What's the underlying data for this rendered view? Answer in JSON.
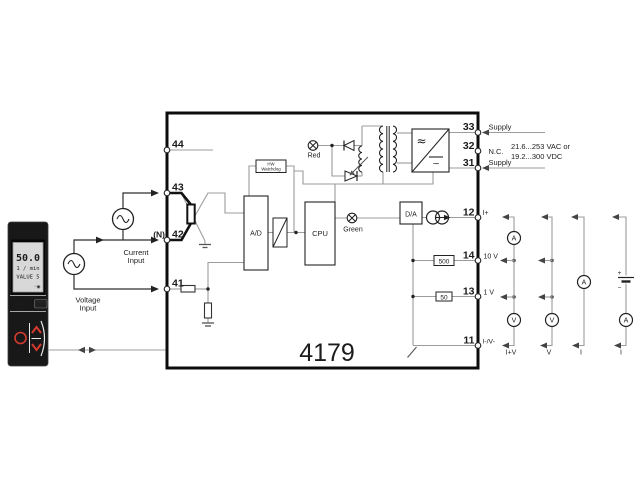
{
  "product_number": "4179",
  "front_unit": {
    "display_value": "50.0",
    "display_unit": "1 / min",
    "display_tag": "VALUE 5",
    "display_icons": "◦◉",
    "brand": "PR",
    "model": "4510"
  },
  "sources": {
    "current_input_line1": "Current",
    "current_input_line2": "Input",
    "voltage_input_line1": "Voltage",
    "voltage_input_line2": "Input",
    "neutral_mark": "(N)"
  },
  "terminals": {
    "t44": "44",
    "t43": "43",
    "t42": "42",
    "t41": "41",
    "t33": "33",
    "t32": "32",
    "t31": "31",
    "t12": "12",
    "t14": "14",
    "t13": "13",
    "t11": "11",
    "t33_label": "Supply",
    "t32_label": "N.C.",
    "t31_label": "Supply",
    "t12_label": "I+",
    "t14_label": "10 V",
    "t13_label": "1 V",
    "t11_label": "I-/V-"
  },
  "power": {
    "range_line1": "21.6...253 VAC or",
    "range_line2": "19.2...300 VDC",
    "ac_symbol": "≈",
    "dc_symbol": "~"
  },
  "blocks": {
    "adc": "A/D",
    "cpu": "CPU",
    "dac": "D/A",
    "watchdog_line1": "HW",
    "watchdog_line2": "Watchdog",
    "resistor_500": "500",
    "resistor_50": "50"
  },
  "leds": {
    "red": "Red",
    "green": "Green"
  },
  "output_meters": {
    "ammeter_top": "A",
    "voltmeter_1": "V",
    "voltmeter_2": "V",
    "ammeter_mid": "A",
    "ammeter_bottom": "A",
    "battery_plus": "+",
    "battery_minus": "−",
    "mode_1": "I+V",
    "mode_2": "V",
    "mode_3": "I",
    "mode_4": "I"
  },
  "colors": {
    "accent_red": "#d63a2f",
    "wire": "#9c9c9c",
    "ink": "#1c1c1c"
  }
}
